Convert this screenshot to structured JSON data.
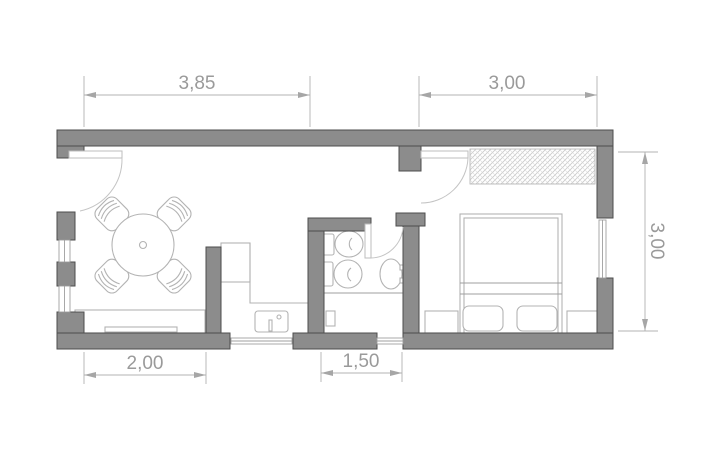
{
  "plan": {
    "dimensions": {
      "top_left": "3,85",
      "top_right": "3,00",
      "right_side": "3,00",
      "bottom_left": "2,00",
      "bottom_middle": "1,50"
    },
    "colors": {
      "wall_fill": "#8c8c8c",
      "wall_outline": "#4d4d4d",
      "furniture_line": "#b3b3b3",
      "dimension_line": "#b3b3b3",
      "dimension_arrow": "#a6a6a6",
      "dimension_text": "#9a9a9a",
      "hatch_line": "#c9c9c9",
      "background": "#ffffff"
    },
    "icons": {
      "dining_table": "round-table-with-four-chairs",
      "sideboard": "sideboard",
      "fridge": "tall-cabinet",
      "kitchen_sink": "sink-with-faucet",
      "toilet": "toilet",
      "bidet": "bidet",
      "washbasin": "oval-washbasin",
      "shower": "shower-area-with-drain",
      "wardrobe": "hatched-wardrobe",
      "bed": "double-bed-with-two-pillows",
      "nightstands": "two-nightstands",
      "doors": "quarter-circle-door-swings",
      "windows": "double-line-windows"
    }
  }
}
